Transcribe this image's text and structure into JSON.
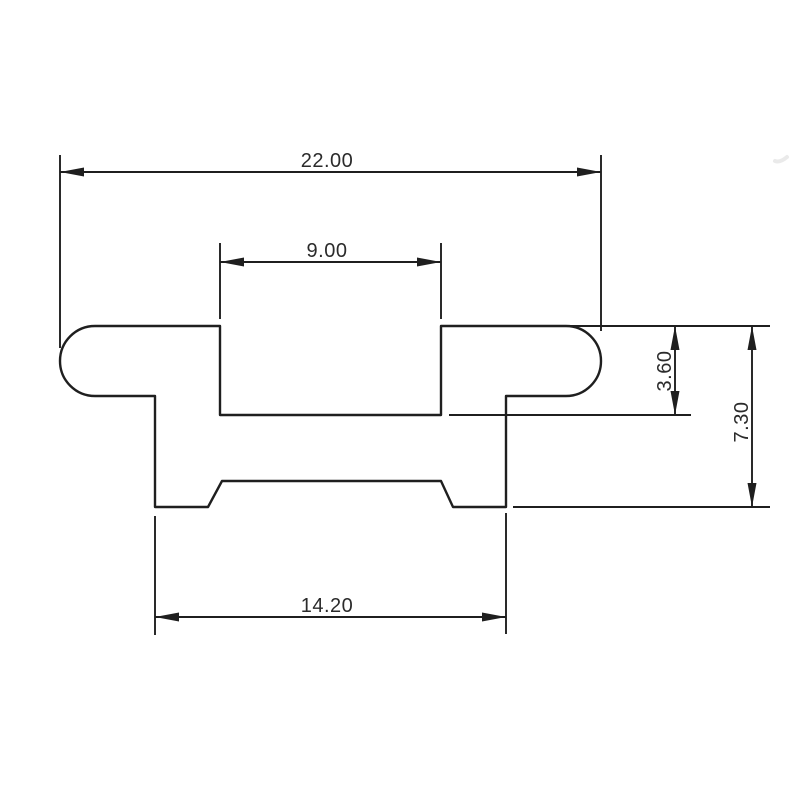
{
  "drawing": {
    "dimensions": {
      "total_width": "22.00",
      "slot_width": "9.00",
      "slot_depth": "3.60",
      "total_height": "7.30",
      "base_width": "14.20"
    },
    "colors": {
      "background": "#ffffff",
      "line": "#1f1f1f",
      "text": "#2b2b2b"
    }
  }
}
